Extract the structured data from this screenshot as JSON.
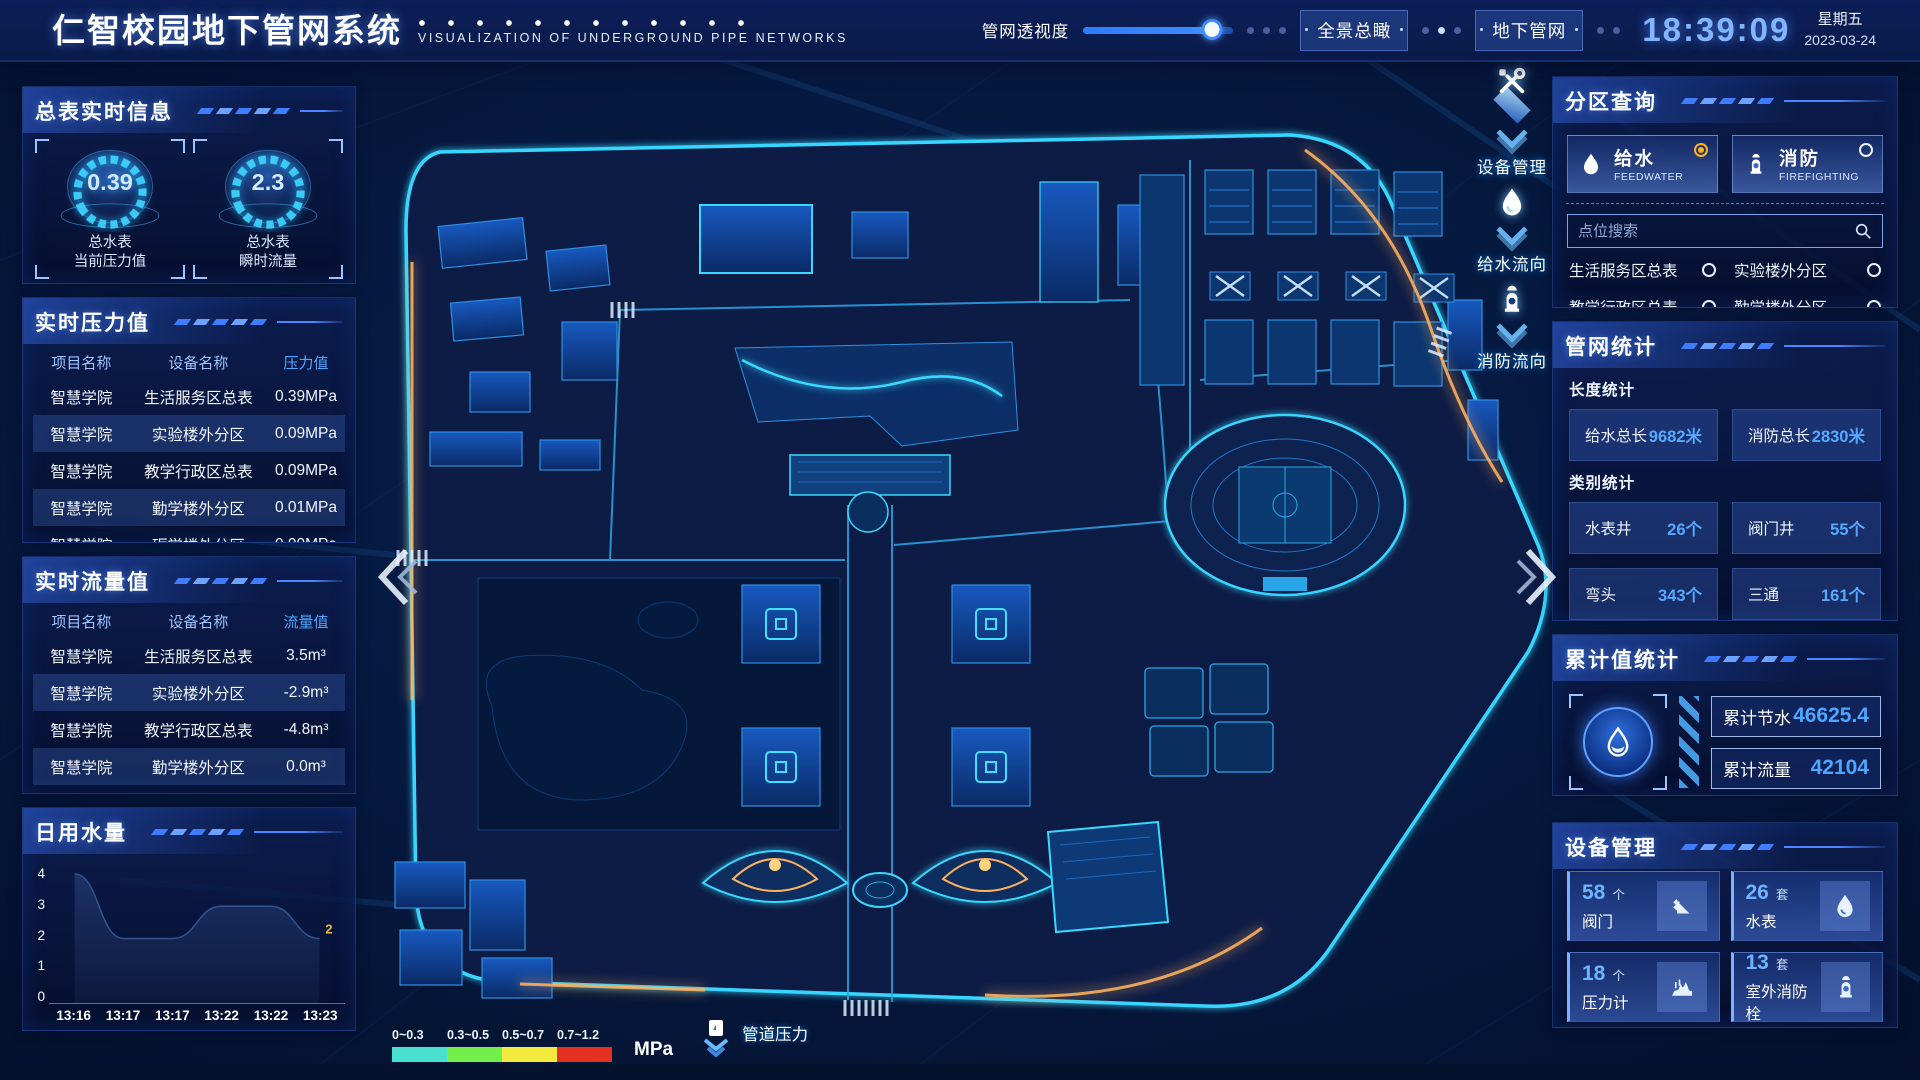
{
  "header": {
    "title": "仁智校园地下管网系统",
    "subtitle": "VISUALIZATION OF UNDERGROUND PIPE NETWORKS",
    "slider_label": "管网透视度",
    "slider_percent": 86,
    "btn_overview": "全景总瞰",
    "btn_underground": "地下管网",
    "time": "18:39:09",
    "weekday": "星期五",
    "date": "2023-03-24"
  },
  "left": {
    "realtime": {
      "title": "总表实时信息",
      "gauges": [
        {
          "value": "0.39",
          "line1": "总水表",
          "line2": "当前压力值"
        },
        {
          "value": "2.3",
          "line1": "总水表",
          "line2": "瞬时流量"
        }
      ]
    },
    "pressure": {
      "title": "实时压力值",
      "headers": [
        "项目名称",
        "设备名称",
        "压力值"
      ],
      "rows": [
        [
          "智慧学院",
          "生活服务区总表",
          "0.39MPa"
        ],
        [
          "智慧学院",
          "实验楼外分区",
          "0.09MPa"
        ],
        [
          "智慧学院",
          "教学行政区总表",
          "0.09MPa"
        ],
        [
          "智慧学院",
          "勤学楼外分区",
          "0.01MPa"
        ],
        [
          "智慧学院",
          "砺学楼外分区",
          "0.00MPa"
        ]
      ]
    },
    "flow": {
      "title": "实时流量值",
      "headers": [
        "项目名称",
        "设备名称",
        "流量值"
      ],
      "rows": [
        [
          "智慧学院",
          "生活服务区总表",
          "3.5m³"
        ],
        [
          "智慧学院",
          "实验楼外分区",
          "-2.9m³"
        ],
        [
          "智慧学院",
          "教学行政区总表",
          "-4.8m³"
        ],
        [
          "智慧学院",
          "勤学楼外分区",
          "0.0m³"
        ],
        [
          "智慧学院",
          "砺学楼外分区",
          "2.3m³"
        ]
      ]
    },
    "daily": {
      "title": "日用水量"
    }
  },
  "chart_data": {
    "type": "area",
    "title": "日用水量",
    "x": [
      "13:16",
      "13:17",
      "13:17",
      "13:22",
      "13:22",
      "13:23"
    ],
    "values": [
      4,
      2,
      2,
      3,
      3,
      2
    ],
    "ylim": [
      0,
      4
    ],
    "yticks": [
      4,
      3,
      2,
      1,
      0
    ],
    "end_label": "2",
    "legend_position": "none",
    "grid": false
  },
  "map": {
    "legend": {
      "ranges": [
        "0~0.3",
        "0.3~0.5",
        "0.5~0.7",
        "0.7~1.2"
      ],
      "colors": [
        "#49e0cf",
        "#74ee4b",
        "#f2ea3d",
        "#e3301f"
      ],
      "unit": "MPa",
      "marker_label": "管道压力"
    },
    "tools": [
      {
        "label": "设备管理",
        "icon": "tools-icon"
      },
      {
        "label": "给水流向",
        "icon": "water-drop-icon"
      },
      {
        "label": "消防流向",
        "icon": "hydrant-icon"
      }
    ]
  },
  "right": {
    "zone_query": {
      "title": "分区查询",
      "tabs": [
        {
          "label": "给水",
          "sub": "FEEDWATER",
          "selected": true
        },
        {
          "label": "消防",
          "sub": "FIREFIGHTING",
          "selected": false
        }
      ],
      "search_placeholder": "点位搜索",
      "items": [
        "生活服务区总表",
        "实验楼外分区",
        "教学行政区总表",
        "勤学楼外分区",
        "砺学楼外分区",
        "宿舍区泵房"
      ]
    },
    "pipe_stats": {
      "title": "管网统计",
      "length_title": "长度统计",
      "length_stats": [
        {
          "label": "给水总长",
          "value": "9682米"
        },
        {
          "label": "消防总长",
          "value": "2830米"
        }
      ],
      "category_title": "类别统计",
      "category_stats": [
        {
          "label": "水表井",
          "value": "26个"
        },
        {
          "label": "阀门井",
          "value": "55个"
        },
        {
          "label": "弯头",
          "value": "343个"
        },
        {
          "label": "三通",
          "value": "161个"
        }
      ]
    },
    "cumulative": {
      "title": "累计值统计",
      "stats": [
        {
          "label": "累计节水",
          "value": "46625.4"
        },
        {
          "label": "累计流量",
          "value": "42104"
        }
      ]
    },
    "devices": {
      "title": "设备管理",
      "cards": [
        {
          "count": "58",
          "unit": "个",
          "label": "阀门",
          "icon": "valve-icon"
        },
        {
          "count": "26",
          "unit": "套",
          "label": "水表",
          "icon": "water-meter-icon"
        },
        {
          "count": "18",
          "unit": "个",
          "label": "压力计",
          "icon": "pressure-gauge-icon"
        },
        {
          "count": "13",
          "unit": "套",
          "label": "室外消防栓",
          "icon": "hydrant-icon"
        }
      ]
    }
  }
}
